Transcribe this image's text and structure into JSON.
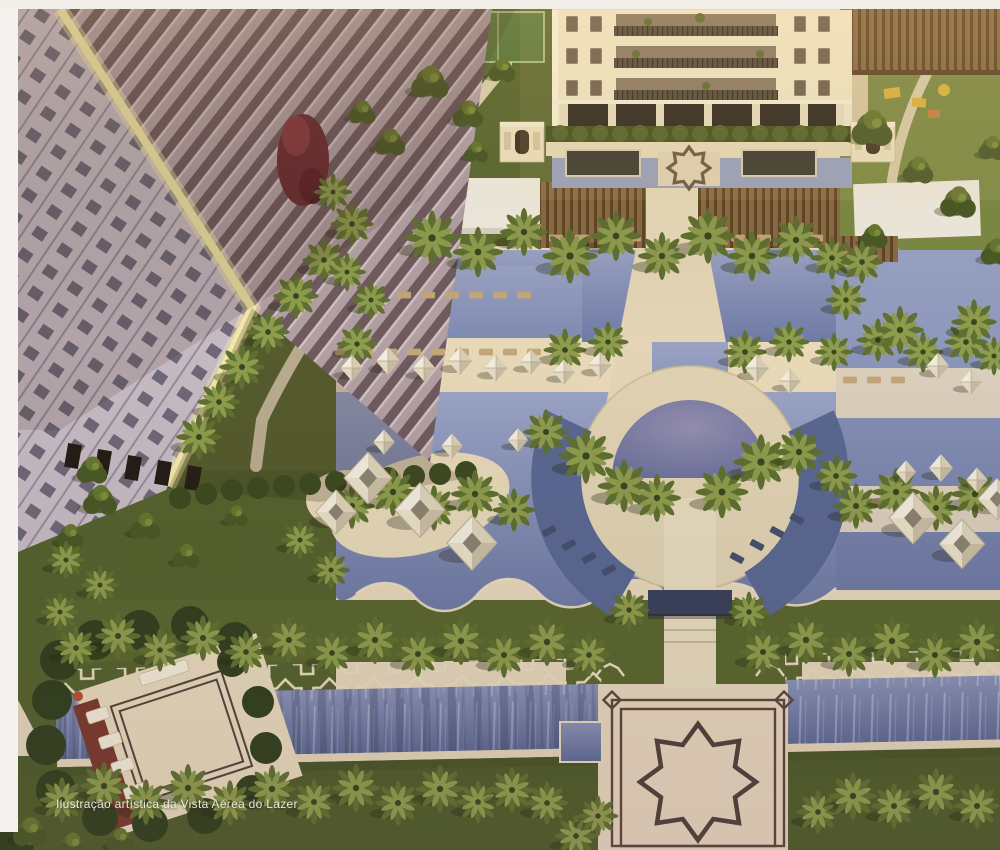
{
  "caption": "Ilustração artística da Vista Aérea do Lazer",
  "colors": {
    "margin-white": "#f4f2ee",
    "caption-color": "#eae7dd",
    "deck_cream": "#e9dab9",
    "deck_pink": "#e4d4bd",
    "pool_light": "#98a1c2",
    "pool_deep": "#5a6892",
    "canal_water": "#7d88b0",
    "lawn_bright": "#7c8a44",
    "lawn_dark": "#55622e",
    "palm_frond": "#6d7d33",
    "tower_cream": "#f2e8c8",
    "facade_mauve": "#b29fa3",
    "sunlit_edge": "#f2e9a8",
    "pergola_wood": "#8a6a41",
    "star_outline": "#52403a",
    "umbrella_white": "#f0e9d9"
  },
  "scene": {
    "palms": [
      [
        432,
        238,
        1.15
      ],
      [
        478,
        252,
        1.05
      ],
      [
        524,
        232,
        1
      ],
      [
        570,
        256,
        1.15
      ],
      [
        616,
        236,
        1.05
      ],
      [
        662,
        256,
        1
      ],
      [
        708,
        236,
        1.15
      ],
      [
        752,
        256,
        1.05
      ],
      [
        796,
        240,
        1
      ],
      [
        832,
        258,
        0.9
      ],
      [
        352,
        224,
        0.9
      ],
      [
        324,
        260,
        0.9
      ],
      [
        296,
        296,
        0.95
      ],
      [
        268,
        332,
        0.9
      ],
      [
        242,
        367,
        0.95
      ],
      [
        219,
        402,
        0.9
      ],
      [
        199,
        437,
        0.95
      ],
      [
        347,
        272,
        0.8
      ],
      [
        371,
        300,
        0.8
      ],
      [
        333,
        192,
        0.8
      ],
      [
        357,
        344,
        0.85
      ],
      [
        565,
        350,
        0.9
      ],
      [
        608,
        342,
        0.85
      ],
      [
        745,
        352,
        0.9
      ],
      [
        789,
        342,
        0.85
      ],
      [
        834,
        352,
        0.8
      ],
      [
        878,
        340,
        0.9
      ],
      [
        923,
        352,
        0.85
      ],
      [
        966,
        342,
        0.9
      ],
      [
        994,
        356,
        0.8
      ],
      [
        586,
        456,
        1.15
      ],
      [
        624,
        486,
        1.1
      ],
      [
        657,
        498,
        1
      ],
      [
        722,
        492,
        1.1
      ],
      [
        761,
        462,
        1.15
      ],
      [
        799,
        452,
        1
      ],
      [
        546,
        432,
        0.95
      ],
      [
        836,
        476,
        0.9
      ],
      [
        352,
        506,
        0.95
      ],
      [
        393,
        492,
        1
      ],
      [
        434,
        508,
        0.95
      ],
      [
        475,
        494,
        1
      ],
      [
        514,
        510,
        0.9
      ],
      [
        856,
        506,
        0.95
      ],
      [
        896,
        492,
        1
      ],
      [
        936,
        508,
        0.95
      ],
      [
        975,
        494,
        1
      ],
      [
        76,
        648,
        0.9
      ],
      [
        118,
        636,
        0.95
      ],
      [
        160,
        650,
        0.9
      ],
      [
        203,
        638,
        0.95
      ],
      [
        246,
        652,
        0.9
      ],
      [
        289,
        640,
        0.95
      ],
      [
        332,
        653,
        0.9
      ],
      [
        375,
        640,
        1
      ],
      [
        418,
        654,
        0.95
      ],
      [
        461,
        641,
        1
      ],
      [
        504,
        655,
        0.95
      ],
      [
        547,
        642,
        1
      ],
      [
        589,
        655,
        0.9
      ],
      [
        629,
        610,
        0.85
      ],
      [
        749,
        612,
        0.85
      ],
      [
        763,
        652,
        0.95
      ],
      [
        806,
        640,
        1
      ],
      [
        849,
        654,
        0.95
      ],
      [
        892,
        641,
        1
      ],
      [
        935,
        655,
        0.95
      ],
      [
        977,
        642,
        1
      ],
      [
        62,
        800,
        0.95
      ],
      [
        104,
        786,
        1
      ],
      [
        146,
        802,
        0.95
      ],
      [
        188,
        788,
        1
      ],
      [
        230,
        803,
        0.95
      ],
      [
        272,
        789,
        1
      ],
      [
        314,
        802,
        0.95
      ],
      [
        356,
        788,
        1
      ],
      [
        398,
        803,
        0.95
      ],
      [
        440,
        789,
        1
      ],
      [
        478,
        802,
        0.9
      ],
      [
        512,
        790,
        0.95
      ],
      [
        547,
        803,
        0.9
      ],
      [
        576,
        836,
        0.9
      ],
      [
        598,
        816,
        0.85
      ],
      [
        818,
        812,
        0.9
      ],
      [
        853,
        796,
        1
      ],
      [
        894,
        806,
        0.95
      ],
      [
        936,
        792,
        1
      ],
      [
        977,
        806,
        0.95
      ],
      [
        66,
        560,
        0.8
      ],
      [
        100,
        585,
        0.8
      ],
      [
        60,
        612,
        0.8
      ],
      [
        300,
        540,
        0.8
      ],
      [
        331,
        570,
        0.8
      ],
      [
        862,
        262,
        0.9
      ],
      [
        900,
        330,
        1
      ],
      [
        974,
        322,
        0.95
      ],
      [
        846,
        300,
        0.85
      ]
    ],
    "trees": [
      [
        430,
        82,
        1.1
      ],
      [
        468,
        114,
        0.9
      ],
      [
        502,
        70,
        0.8
      ],
      [
        872,
        128,
        1.2
      ],
      [
        918,
        170,
        0.9
      ],
      [
        958,
        202,
        1.05
      ],
      [
        992,
        148,
        0.8
      ],
      [
        874,
        236,
        0.8
      ],
      [
        996,
        252,
        0.9
      ],
      [
        100,
        500,
        1
      ],
      [
        145,
        526,
        0.9
      ],
      [
        70,
        536,
        0.8
      ],
      [
        186,
        556,
        0.8
      ],
      [
        236,
        516,
        0.7
      ],
      [
        92,
        470,
        0.9
      ],
      [
        390,
        142,
        0.9
      ],
      [
        362,
        112,
        0.8
      ],
      [
        476,
        152,
        0.7
      ],
      [
        30,
        832,
        1
      ],
      [
        72,
        846,
        0.9
      ],
      [
        120,
        840,
        0.8
      ]
    ],
    "umbrellas": [
      [
        352,
        368,
        0.95
      ],
      [
        388,
        361,
        1
      ],
      [
        424,
        368,
        0.95
      ],
      [
        460,
        361,
        1
      ],
      [
        496,
        368,
        0.95
      ],
      [
        531,
        362,
        0.9
      ],
      [
        564,
        372,
        0.9
      ],
      [
        600,
        365,
        0.95
      ],
      [
        384,
        442,
        0.9
      ],
      [
        452,
        446,
        0.9
      ],
      [
        518,
        440,
        0.85
      ],
      [
        757,
        368,
        1
      ],
      [
        790,
        381,
        0.9
      ],
      [
        938,
        366,
        0.95
      ],
      [
        971,
        382,
        0.9
      ],
      [
        941,
        468,
        1
      ],
      [
        977,
        480,
        0.9
      ],
      [
        906,
        472,
        0.85
      ]
    ],
    "cabanas": [
      [
        368,
        478,
        1
      ],
      [
        420,
        510,
        1.05
      ],
      [
        472,
        543,
        1.05
      ],
      [
        336,
        512,
        0.85
      ],
      [
        913,
        518,
        1
      ],
      [
        962,
        544,
        0.95
      ],
      [
        997,
        499,
        0.8
      ]
    ],
    "loungers_tan": [
      [
        342,
        352
      ],
      [
        366,
        352
      ],
      [
        390,
        352
      ],
      [
        414,
        352
      ],
      [
        438,
        352
      ],
      [
        462,
        352
      ],
      [
        486,
        352
      ],
      [
        510,
        352
      ],
      [
        534,
        352
      ],
      [
        404,
        295
      ],
      [
        428,
        295
      ],
      [
        452,
        295
      ],
      [
        476,
        295
      ],
      [
        500,
        295
      ],
      [
        524,
        295
      ],
      [
        556,
        238
      ],
      [
        582,
        238
      ],
      [
        608,
        238
      ],
      [
        634,
        238
      ],
      [
        712,
        238
      ],
      [
        738,
        238
      ],
      [
        764,
        238
      ],
      [
        790,
        238
      ],
      [
        816,
        238
      ],
      [
        850,
        380
      ],
      [
        874,
        380
      ],
      [
        898,
        380
      ],
      [
        876,
        502
      ],
      [
        900,
        502
      ],
      [
        924,
        502
      ]
    ],
    "loungers_dark": [
      [
        549,
        531,
        -28
      ],
      [
        569,
        545,
        -28
      ],
      [
        589,
        558,
        -28
      ],
      [
        609,
        570,
        -28
      ],
      [
        737,
        558,
        28
      ],
      [
        757,
        545,
        28
      ],
      [
        777,
        532,
        28
      ],
      [
        797,
        519,
        28
      ]
    ]
  }
}
